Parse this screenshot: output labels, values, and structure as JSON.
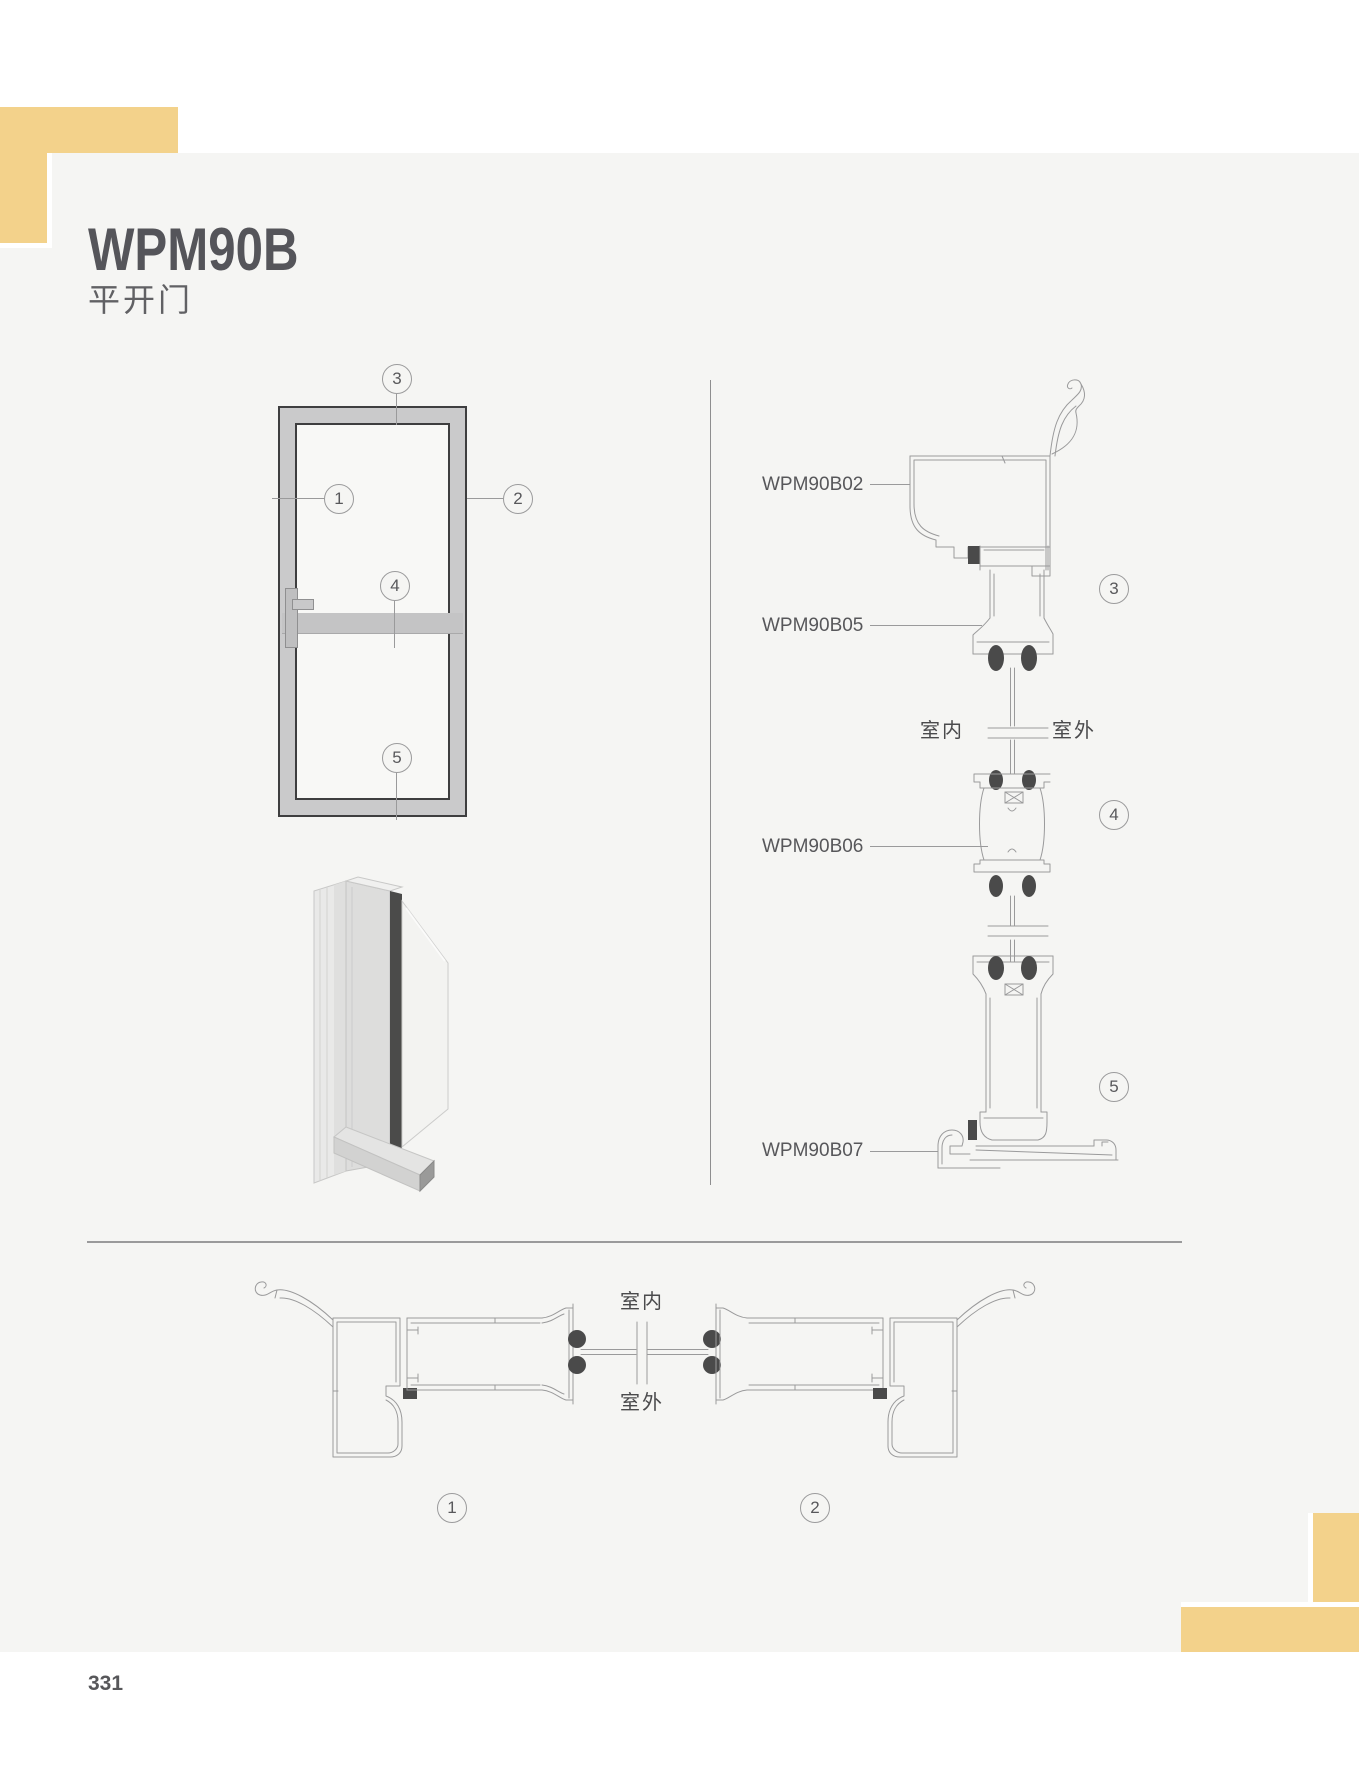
{
  "page": {
    "title": "WPM90B",
    "subtitle": "平开门",
    "page_number": "331"
  },
  "colors": {
    "accent": "#F3D28B",
    "card": "#F5F5F3",
    "line": "#9A9A9B",
    "ink": "#55555A",
    "dark_seal": "#4A4A4A"
  },
  "elevation": {
    "callout_1": "1",
    "callout_2": "2",
    "callout_3": "3",
    "callout_4": "4",
    "callout_5": "5"
  },
  "vertical_section": {
    "label_02": "WPM90B02",
    "label_05": "WPM90B05",
    "label_06": "WPM90B06",
    "label_07": "WPM90B07",
    "indoor": "室内",
    "outdoor": "室外",
    "callout_3": "3",
    "callout_4": "4",
    "callout_5": "5"
  },
  "horizontal_section": {
    "indoor": "室内",
    "outdoor": "室外",
    "callout_1": "1",
    "callout_2": "2"
  }
}
